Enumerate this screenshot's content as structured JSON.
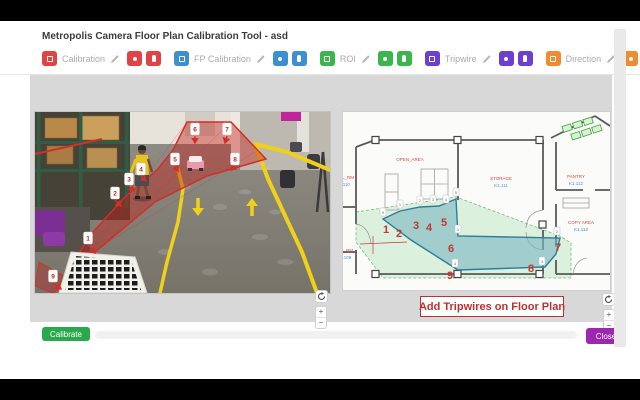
{
  "window": {
    "title": "Metropolis Camera Floor Plan Calibration Tool - asd"
  },
  "toolbar": {
    "groups": [
      {
        "label": "Calibration",
        "color": "#e04343"
      },
      {
        "label": "FP Calibration",
        "color": "#3d8fd4"
      },
      {
        "label": "ROI",
        "color": "#3cb54d"
      },
      {
        "label": "Tripwire",
        "color": "#6d3fd1"
      },
      {
        "label": "Direction",
        "color": "#ef8b30"
      }
    ]
  },
  "icons": {
    "edit": "pencil-icon",
    "refresh": "refresh-arrow-icon",
    "lead_glyph": "square-outline",
    "pair_glyph_1": "dot",
    "pair_glyph_2": "pin"
  },
  "camera_panel": {
    "marker_numbers": [
      "1",
      "2",
      "3",
      "4",
      "5",
      "6",
      "7",
      "8",
      "9"
    ]
  },
  "floorplan_panel": {
    "banner": "Add Tripwires on Floor Plan",
    "tripwire_numbers": [
      "1",
      "2",
      "3",
      "4",
      "5",
      "6",
      "7",
      "8",
      "9"
    ],
    "vertex_labels": [
      "0",
      "1",
      "2",
      "3",
      "4",
      "5",
      "1",
      "2",
      "3",
      "4"
    ],
    "rooms": [
      {
        "name": "OPEN_AREA",
        "id": ""
      },
      {
        "name": "STORAGE",
        "id": "K1.111"
      },
      {
        "name": "PANTRY",
        "id": "K1.112"
      },
      {
        "name": "COPY AREA",
        "id": "K1.112"
      },
      {
        "name": "AL_RM",
        "id": "1.110"
      },
      {
        "name": "G_RM",
        "id": "1.108"
      }
    ]
  },
  "panel_controls": {
    "zoom_in": "+",
    "zoom_out": "−"
  },
  "footer": {
    "calibrate": "Calibrate",
    "close": "Close"
  },
  "colors": {
    "calibrate_green": "#2aa94c",
    "close_purple": "#9c27b0",
    "banner_red": "#c03030",
    "tripwire_region_teal": "#2e7d9a",
    "roi_overlay_red": "#d03028",
    "lane_yellow": "#f0d018"
  }
}
